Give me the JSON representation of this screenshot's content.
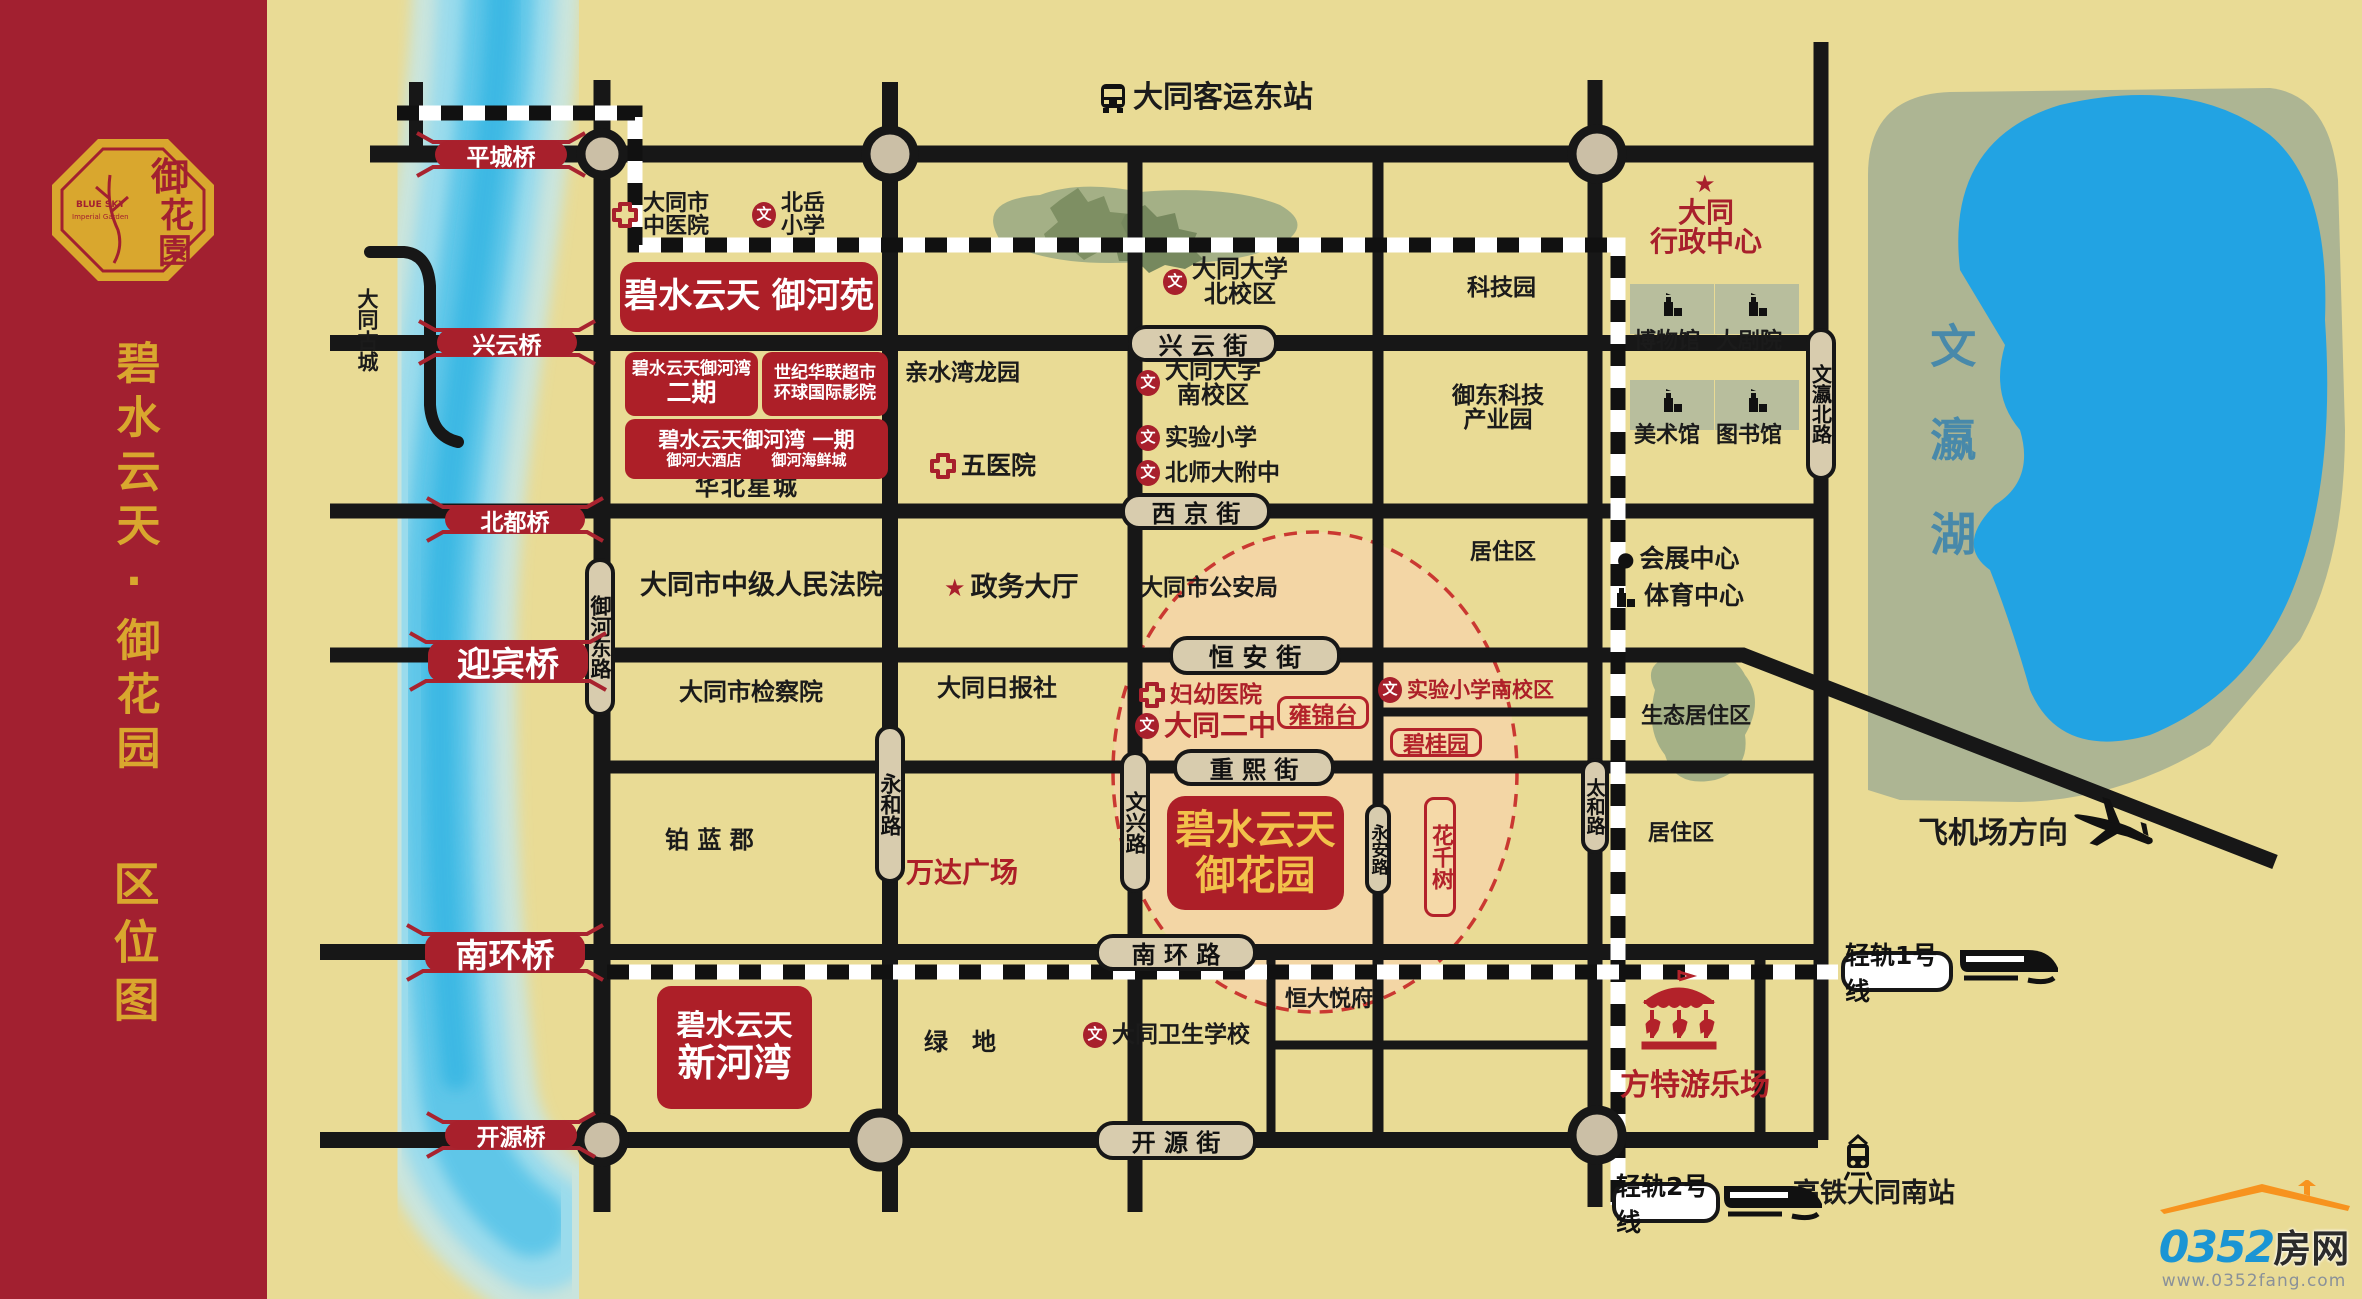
{
  "banner": {
    "title": "碧水云天·御花园",
    "subtitle": "区位图",
    "logo_cn": "御花園",
    "logo_en1": "BLUE SKY",
    "logo_en2": "Imperial Garden"
  },
  "colors": {
    "banner_red": "#A22030",
    "gold": "#D9A72E",
    "map_bg": "#E9DB95",
    "label_red": "#AD1F28",
    "road_black": "#171717",
    "street_tan": "#D8CCAE",
    "river_blue": "#55C3E8",
    "lake_blue": "#22A3E3",
    "park_green": "#ADB593",
    "project_peach": "#F4D6A6",
    "circle_red": "#C9302C",
    "logo_blue": "#1B95D4",
    "logo_orange": "#F7931E"
  },
  "map": {
    "street_labels": [
      {
        "t": "兴 云 街",
        "x": 1128,
        "y": 325,
        "w": 150,
        "h": 37,
        "fs": 24
      },
      {
        "t": "西 京 街",
        "x": 1121,
        "y": 493,
        "w": 150,
        "h": 37,
        "fs": 24
      },
      {
        "t": "恒 安 街",
        "x": 1169,
        "y": 636,
        "w": 172,
        "h": 39,
        "fs": 25
      },
      {
        "t": "重 熙 街",
        "x": 1173,
        "y": 749,
        "w": 162,
        "h": 37,
        "fs": 24
      },
      {
        "t": "南 环 路",
        "x": 1095,
        "y": 934,
        "w": 162,
        "h": 37,
        "fs": 24
      },
      {
        "t": "开 源 街",
        "x": 1095,
        "y": 1121,
        "w": 162,
        "h": 39,
        "fs": 24
      },
      {
        "t": "御河东路",
        "x": 585,
        "y": 558,
        "w": 30,
        "h": 158,
        "fs": 21,
        "v": true
      },
      {
        "t": "永和路",
        "x": 875,
        "y": 725,
        "w": 30,
        "h": 158,
        "fs": 21,
        "v": true
      },
      {
        "t": "文兴路",
        "x": 1120,
        "y": 751,
        "w": 30,
        "h": 142,
        "fs": 21,
        "v": true
      },
      {
        "t": "永安路",
        "x": 1365,
        "y": 803,
        "w": 26,
        "h": 92,
        "fs": 17,
        "v": true
      },
      {
        "t": "太和路",
        "x": 1581,
        "y": 758,
        "w": 28,
        "h": 96,
        "fs": 19,
        "v": true
      },
      {
        "t": "文瀛北路",
        "x": 1806,
        "y": 328,
        "w": 30,
        "h": 152,
        "fs": 20,
        "v": true
      }
    ],
    "bridges": [
      {
        "t": "平城桥",
        "x": 435,
        "y": 141,
        "w": 132,
        "h": 27,
        "fs": 23
      },
      {
        "t": "兴云桥",
        "x": 437,
        "y": 329,
        "w": 140,
        "h": 27,
        "fs": 23
      },
      {
        "t": "北都桥",
        "x": 445,
        "y": 506,
        "w": 140,
        "h": 27,
        "fs": 23
      },
      {
        "t": "迎宾桥",
        "x": 428,
        "y": 641,
        "w": 160,
        "h": 41,
        "fs": 34
      },
      {
        "t": "南环桥",
        "x": 425,
        "y": 933,
        "w": 160,
        "h": 39,
        "fs": 33
      },
      {
        "t": "开源桥",
        "x": 445,
        "y": 1121,
        "w": 132,
        "h": 28,
        "fs": 23
      }
    ],
    "red_boxes": [
      {
        "x": 620,
        "y": 262,
        "w": 258,
        "h": 70,
        "r": 16,
        "lines": [
          {
            "t": "碧水云天 御河苑",
            "fs": 34,
            "fw": 800
          }
        ]
      },
      {
        "x": 625,
        "y": 352,
        "w": 133,
        "h": 64,
        "r": 10,
        "lines": [
          {
            "t": "碧水云天御河湾",
            "fs": 17,
            "fw": 700
          },
          {
            "t": "二期",
            "fs": 25,
            "fw": 800
          }
        ]
      },
      {
        "x": 762,
        "y": 352,
        "w": 126,
        "h": 64,
        "r": 10,
        "lines": [
          {
            "t": "世纪华联超市",
            "fs": 17,
            "fw": 700
          },
          {
            "t": "环球国际影院",
            "fs": 17,
            "fw": 700
          }
        ]
      },
      {
        "x": 625,
        "y": 419,
        "w": 263,
        "h": 60,
        "r": 10,
        "lines": [
          {
            "t": "碧水云天御河湾 一期",
            "fs": 21,
            "fw": 800
          },
          {
            "t": "御河大酒店　　御河海鲜城",
            "fs": 15,
            "fw": 700
          }
        ]
      },
      {
        "x": 1167,
        "y": 796,
        "w": 177,
        "h": 114,
        "r": 18,
        "gold": true,
        "lines": [
          {
            "t": "碧水云天",
            "fs": 40,
            "fw": 800
          },
          {
            "t": "御花园",
            "fs": 40,
            "fw": 800
          }
        ]
      },
      {
        "x": 657,
        "y": 986,
        "w": 155,
        "h": 123,
        "r": 14,
        "lines": [
          {
            "t": "碧水云天",
            "fs": 29,
            "fw": 700
          },
          {
            "t": "新河湾",
            "fs": 38,
            "fw": 800
          }
        ]
      }
    ],
    "outline_boxes": [
      {
        "t": "雍锦台",
        "x": 1277,
        "y": 696,
        "w": 92,
        "h": 33,
        "fs": 23
      },
      {
        "t": "碧桂园",
        "x": 1390,
        "y": 728,
        "w": 92,
        "h": 29,
        "fs": 22
      },
      {
        "t": "花千树",
        "x": 1424,
        "y": 797,
        "w": 32,
        "h": 120,
        "fs": 22,
        "v": true
      }
    ],
    "pois": [
      {
        "id": "bus-station",
        "lines": [
          "大同客运东站"
        ],
        "x": 1098,
        "y": 82,
        "fs": 30,
        "fw": 800,
        "icon": "bus"
      },
      {
        "id": "zhongyiyuan",
        "lines": [
          "大同市",
          "中医院"
        ],
        "x": 612,
        "y": 192,
        "fs": 22,
        "icon": "cross"
      },
      {
        "id": "beiyue",
        "lines": [
          "北岳",
          "小学"
        ],
        "x": 752,
        "y": 192,
        "fs": 22,
        "icon": "wen"
      },
      {
        "id": "datong-univ-north",
        "lines": [
          "大同大学",
          "北校区"
        ],
        "x": 1163,
        "y": 257,
        "fs": 24,
        "icon": "wen"
      },
      {
        "id": "keji-park",
        "lines": [
          "科技园"
        ],
        "x": 1467,
        "y": 276,
        "fs": 23
      },
      {
        "id": "qinshuiwan",
        "lines": [
          "亲水湾龙园"
        ],
        "x": 905,
        "y": 361,
        "fs": 23
      },
      {
        "id": "wuyiyuan",
        "lines": [
          "五医院"
        ],
        "x": 930,
        "y": 453,
        "fs": 25,
        "icon": "cross"
      },
      {
        "id": "datong-univ-south",
        "lines": [
          "大同大学",
          "南校区"
        ],
        "x": 1136,
        "y": 358,
        "fs": 24,
        "icon": "wen"
      },
      {
        "id": "shiyan-primary",
        "lines": [
          "实验小学"
        ],
        "x": 1136,
        "y": 425,
        "fs": 23,
        "icon": "wen"
      },
      {
        "id": "beishida",
        "lines": [
          "北师大附中"
        ],
        "x": 1136,
        "y": 460,
        "fs": 23,
        "icon": "wen"
      },
      {
        "id": "yudong-keji",
        "lines": [
          "御东科技",
          "产业园"
        ],
        "x": 1452,
        "y": 384,
        "fs": 23
      },
      {
        "id": "huabei-xingcheng",
        "lines": [
          "华北星城"
        ],
        "x": 695,
        "y": 475,
        "fs": 24,
        "ls": 2
      },
      {
        "id": "court",
        "lines": [
          "大同市中级人民法院"
        ],
        "x": 640,
        "y": 572,
        "fs": 27
      },
      {
        "id": "zhengwu",
        "lines": [
          "政务大厅"
        ],
        "x": 944,
        "y": 574,
        "fs": 27,
        "icon": "star"
      },
      {
        "id": "police",
        "lines": [
          "大同市公安局"
        ],
        "x": 1140,
        "y": 576,
        "fs": 23
      },
      {
        "id": "juzhuqu-1",
        "lines": [
          "居住区"
        ],
        "x": 1470,
        "y": 541,
        "fs": 22
      },
      {
        "id": "ribao",
        "lines": [
          "大同日报社"
        ],
        "x": 937,
        "y": 676,
        "fs": 24
      },
      {
        "id": "jianchayuan",
        "lines": [
          "大同市检察院"
        ],
        "x": 679,
        "y": 680,
        "fs": 24
      },
      {
        "id": "fuyou",
        "lines": [
          "妇幼医院"
        ],
        "x": 1139,
        "y": 682,
        "fs": 23,
        "icon": "cross",
        "color": "#AD1F28"
      },
      {
        "id": "datong-erzhong",
        "lines": [
          "大同二中"
        ],
        "x": 1135,
        "y": 711,
        "fs": 28,
        "fw": 800,
        "icon": "wen",
        "color": "#AD1F28"
      },
      {
        "id": "shiyan-south",
        "lines": [
          "实验小学南校区"
        ],
        "x": 1378,
        "y": 677,
        "fs": 21,
        "icon": "wen",
        "color": "#AD1F28"
      },
      {
        "id": "bolanjun",
        "lines": [
          "铂 蓝 郡"
        ],
        "x": 665,
        "y": 828,
        "fs": 24
      },
      {
        "id": "wanda",
        "lines": [
          "万达广场"
        ],
        "x": 906,
        "y": 858,
        "fs": 28,
        "fw": 800,
        "color": "#AD1F28"
      },
      {
        "id": "lvdi",
        "lines": [
          "绿　地"
        ],
        "x": 924,
        "y": 1030,
        "fs": 24
      },
      {
        "id": "weisheng-school",
        "lines": [
          "大同卫生学校"
        ],
        "x": 1083,
        "y": 1022,
        "fs": 23,
        "icon": "wen"
      },
      {
        "id": "hengda",
        "lines": [
          "恒大悦府"
        ],
        "x": 1285,
        "y": 988,
        "fs": 22
      },
      {
        "id": "shengtai",
        "lines": [
          "生态居住区"
        ],
        "x": 1641,
        "y": 705,
        "fs": 22
      },
      {
        "id": "juzhuqu-2",
        "lines": [
          "居住区"
        ],
        "x": 1648,
        "y": 822,
        "fs": 22
      },
      {
        "id": "huizhan",
        "lines": [
          "会展中心"
        ],
        "x": 1617,
        "y": 546,
        "fs": 25,
        "icon": "dot"
      },
      {
        "id": "tiyu",
        "lines": [
          "体育中心"
        ],
        "x": 1613,
        "y": 583,
        "fs": 25,
        "icon": "building"
      },
      {
        "id": "bowuguan",
        "lines": [
          "博物馆"
        ],
        "x": 1634,
        "y": 330,
        "fs": 22
      },
      {
        "id": "dajuyuan",
        "lines": [
          "大剧院"
        ],
        "x": 1716,
        "y": 330,
        "fs": 22
      },
      {
        "id": "meishuguan",
        "lines": [
          "美术馆"
        ],
        "x": 1634,
        "y": 424,
        "fs": 22
      },
      {
        "id": "tushuguan",
        "lines": [
          "图书馆"
        ],
        "x": 1716,
        "y": 424,
        "fs": 22
      },
      {
        "id": "xingzheng",
        "lines": [
          "大同",
          "行政中心"
        ],
        "x": 1650,
        "y": 198,
        "fs": 28,
        "fw": 800,
        "color": "#A8202C"
      },
      {
        "id": "xingzheng-star",
        "lines": [],
        "x": 1694,
        "y": 172,
        "icon": "star"
      },
      {
        "id": "fangte",
        "lines": [
          "方特游乐场"
        ],
        "x": 1620,
        "y": 1070,
        "fs": 30,
        "fw": 800,
        "color": "#AD1F28"
      },
      {
        "id": "fangte-icon",
        "lines": [],
        "x": 1634,
        "y": 968,
        "icon": "carousel"
      },
      {
        "id": "airport",
        "lines": [
          "飞机场方向"
        ],
        "x": 1918,
        "y": 818,
        "fs": 30,
        "fw": 800
      },
      {
        "id": "airport-plane",
        "lines": [],
        "x": 2068,
        "y": 786,
        "icon": "plane"
      },
      {
        "id": "hsr-station",
        "lines": [
          "高铁大同南站"
        ],
        "x": 1793,
        "y": 1180,
        "fs": 27,
        "fw": 800
      },
      {
        "id": "hsr-icon",
        "lines": [],
        "x": 1843,
        "y": 1134,
        "icon": "tram"
      },
      {
        "id": "train1",
        "lines": [],
        "x": 1958,
        "y": 940,
        "icon": "train"
      },
      {
        "id": "train2",
        "lines": [],
        "x": 1722,
        "y": 1176,
        "icon": "train"
      },
      {
        "id": "gucheng",
        "lines": [
          "大同古城"
        ],
        "x": 356,
        "y": 288,
        "fs": 21,
        "v": true
      },
      {
        "id": "lake-label",
        "lines": [
          "文瀛湖"
        ],
        "x": 1926,
        "y": 322,
        "fs": 46,
        "fw": 800,
        "v": true,
        "color": "#2F7FB0",
        "ls": 48,
        "op": 0.8
      },
      {
        "id": "mus-ic-1",
        "lines": [],
        "x": 1660,
        "y": 292,
        "icon": "building"
      },
      {
        "id": "mus-ic-2",
        "lines": [],
        "x": 1745,
        "y": 292,
        "icon": "building"
      },
      {
        "id": "mus-ic-3",
        "lines": [],
        "x": 1660,
        "y": 388,
        "icon": "building"
      },
      {
        "id": "mus-ic-4",
        "lines": [],
        "x": 1745,
        "y": 388,
        "icon": "building"
      }
    ],
    "transit_labels": [
      {
        "t": "轻轨1号线",
        "x": 1841,
        "y": 951,
        "w": 112,
        "h": 41,
        "fs": 25
      },
      {
        "t": "轻轨2号线",
        "x": 1612,
        "y": 1182,
        "w": 108,
        "h": 41,
        "fs": 25
      }
    ]
  },
  "logo": {
    "num": "0352",
    "cn": "房网",
    "url": "www.0352fang.com"
  }
}
